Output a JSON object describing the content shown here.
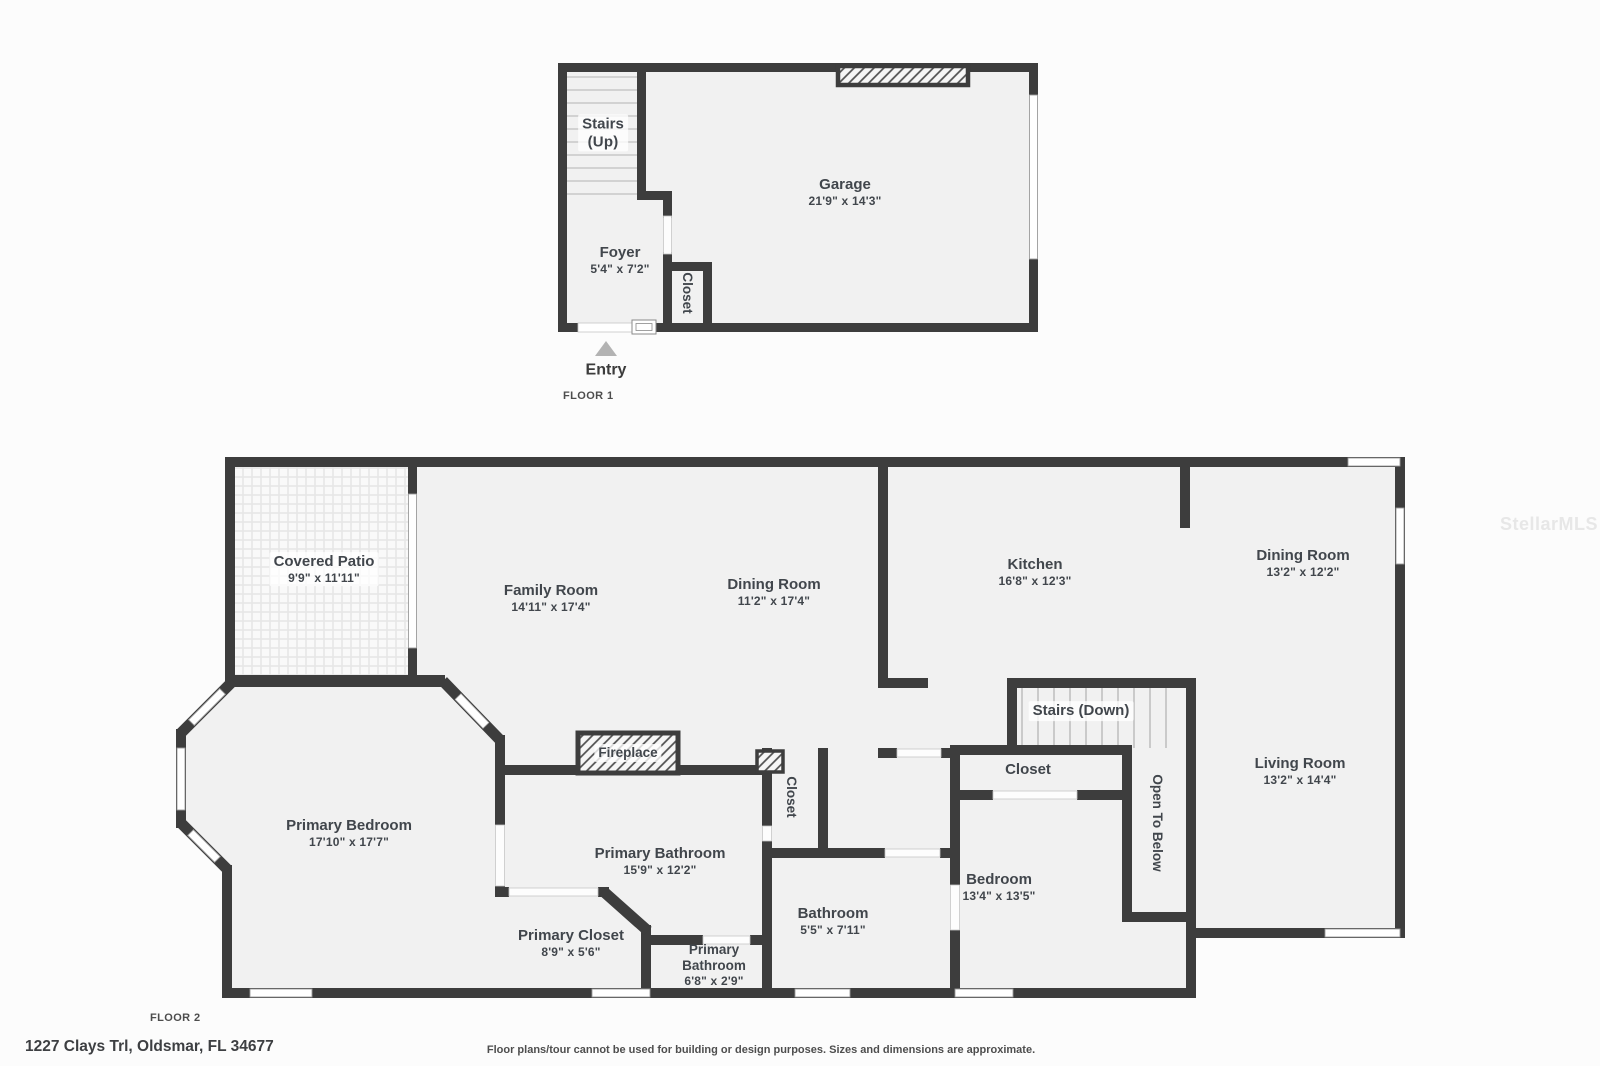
{
  "page": {
    "wall_color": "#3d3d3d",
    "room_fill": "#f1f1f1",
    "background": "#fcfcfc",
    "text_color": "#41464c"
  },
  "watermark": "StellarMLS",
  "footer": {
    "address": "1227 Clays Trl, Oldsmar, FL 34677",
    "disclaimer": "Floor plans/tour cannot be used for building or design purposes. Sizes and dimensions are approximate."
  },
  "floor1": {
    "label": "FLOOR 1",
    "entry_label": "Entry",
    "rooms": {
      "stairs_up": {
        "name": "Stairs",
        "dims": "(Up)"
      },
      "garage": {
        "name": "Garage",
        "dims": "21'9\" x 14'3\""
      },
      "foyer": {
        "name": "Foyer",
        "dims": "5'4\" x 7'2\""
      },
      "closet": {
        "name": "Closet"
      }
    }
  },
  "floor2": {
    "label": "FLOOR 2",
    "rooms": {
      "covered_patio": {
        "name": "Covered Patio",
        "dims": "9'9\" x 11'11\""
      },
      "family_room": {
        "name": "Family Room",
        "dims": "14'11\" x 17'4\""
      },
      "dining_room_left": {
        "name": "Dining Room",
        "dims": "11'2\" x 17'4\""
      },
      "kitchen": {
        "name": "Kitchen",
        "dims": "16'8\" x 12'3\""
      },
      "dining_room_right": {
        "name": "Dining Room",
        "dims": "13'2\" x 12'2\""
      },
      "stairs_down": {
        "name": "Stairs (Down)"
      },
      "closet_hall": {
        "name": "Closet"
      },
      "open_to_below": {
        "name": "Open To Below"
      },
      "living_room": {
        "name": "Living Room",
        "dims": "13'2\" x 14'4\""
      },
      "primary_bedroom": {
        "name": "Primary Bedroom",
        "dims": "17'10\" x 17'7\""
      },
      "fireplace": {
        "name": "Fireplace"
      },
      "closet_primary": {
        "name": "Closet"
      },
      "primary_bathroom": {
        "name": "Primary Bathroom",
        "dims": "15'9\" x 12'2\""
      },
      "primary_closet": {
        "name": "Primary Closet",
        "dims": "8'9\" x 5'6\""
      },
      "primary_bathroom_small": {
        "name": "Primary",
        "name2": "Bathroom",
        "dims": "6'8\" x 2'9\""
      },
      "bathroom": {
        "name": "Bathroom",
        "dims": "5'5\" x 7'11\""
      },
      "bedroom": {
        "name": "Bedroom",
        "dims": "13'4\" x 13'5\""
      }
    }
  }
}
